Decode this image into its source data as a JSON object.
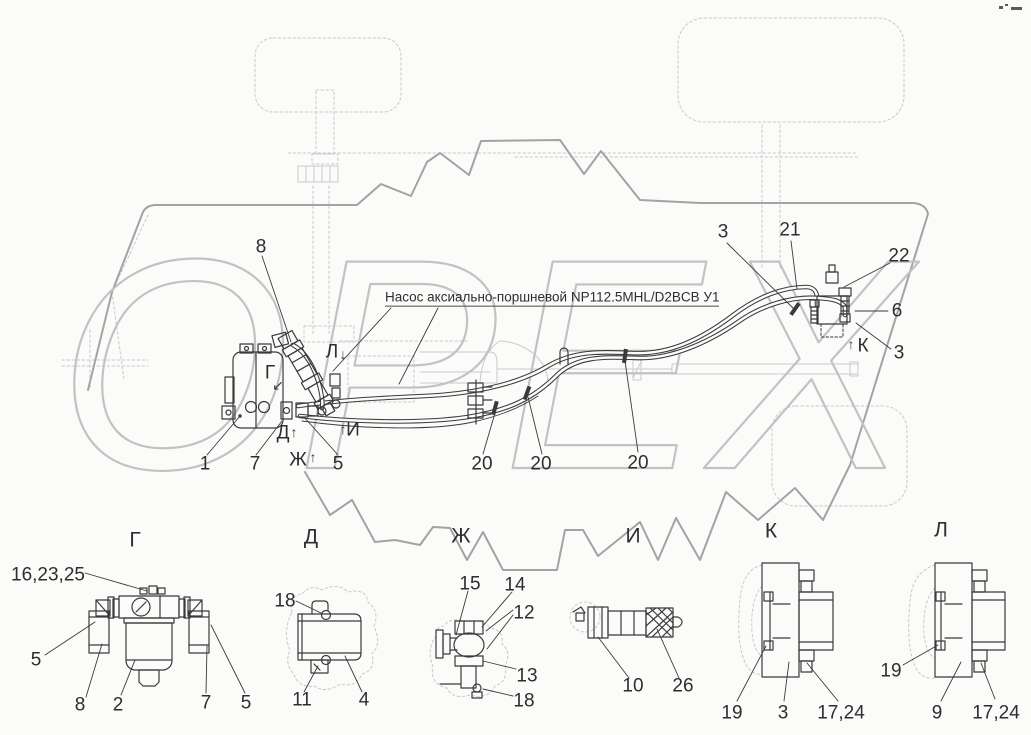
{
  "watermark": {
    "text": "ОРЕХ"
  },
  "pump_label": {
    "text": "Насос аксиально-поршневой NP112.5MHL/D2BCB У1"
  },
  "main": {
    "callouts": {
      "n8": "8",
      "n1": "1",
      "n7": "7",
      "n5": "5",
      "n20a": "20",
      "n20b": "20",
      "n20c": "20",
      "n3a": "3",
      "n21": "21",
      "n22": "22",
      "n6": "6",
      "n3b": "3"
    },
    "marks": {
      "g": "Г",
      "l": "Л",
      "d": "Д",
      "zh": "Ж",
      "i": "И",
      "k": "К"
    },
    "arrows": {
      "up": "↑",
      "down": "↓",
      "diag": "↙"
    }
  },
  "details": {
    "g": {
      "title": "Г",
      "c1": "16,23,25",
      "c2": "5",
      "c3": "8",
      "c4": "2",
      "c5": "7",
      "c6": "5"
    },
    "d": {
      "title": "Д",
      "c1": "18",
      "c2": "11",
      "c3": "4"
    },
    "zh": {
      "title": "Ж",
      "c1": "15",
      "c2": "14",
      "c3": "12",
      "c4": "13",
      "c5": "18"
    },
    "i": {
      "title": "И",
      "c1": "10",
      "c2": "26"
    },
    "k": {
      "title": "К",
      "c1": "19",
      "c2": "3",
      "c3": "17,24"
    },
    "l": {
      "title": "Л",
      "c1": "19",
      "c2": "9",
      "c3": "17,24"
    }
  }
}
